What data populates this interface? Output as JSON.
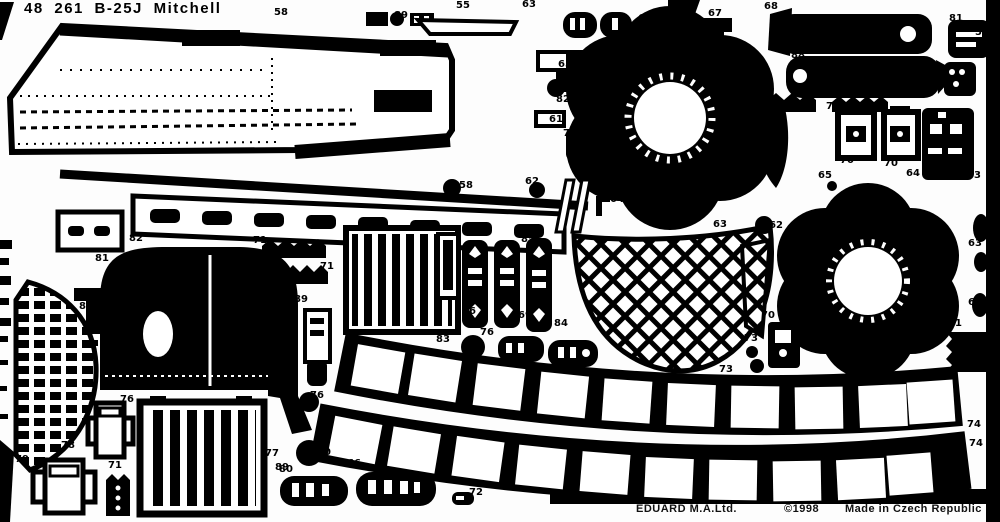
{
  "sheet": {
    "title": "48 261 B-25J Mitchell",
    "footer": {
      "maker": "EDUARD M.A.Ltd.",
      "copyright": "©1998",
      "origin": "Made in Czech Republic"
    }
  },
  "colors": {
    "etch": "#000000",
    "background": "#fdfdfd"
  },
  "parts": [
    {
      "n": "58",
      "x": 274,
      "y": 8
    },
    {
      "n": "89",
      "x": 394,
      "y": 11
    },
    {
      "n": "55",
      "x": 456,
      "y": 1
    },
    {
      "n": "63",
      "x": 522,
      "y": 0
    },
    {
      "n": "69",
      "x": 638,
      "y": 14
    },
    {
      "n": "67",
      "x": 708,
      "y": 9
    },
    {
      "n": "68",
      "x": 764,
      "y": 2
    },
    {
      "n": "88",
      "x": 791,
      "y": 51
    },
    {
      "n": "81",
      "x": 949,
      "y": 14
    },
    {
      "n": "59",
      "x": 975,
      "y": 28
    },
    {
      "n": "71",
      "x": 736,
      "y": 90
    },
    {
      "n": "71",
      "x": 826,
      "y": 102
    },
    {
      "n": "65",
      "x": 558,
      "y": 60
    },
    {
      "n": "82",
      "x": 556,
      "y": 95
    },
    {
      "n": "61",
      "x": 549,
      "y": 115
    },
    {
      "n": "73",
      "x": 563,
      "y": 129
    },
    {
      "n": "70",
      "x": 840,
      "y": 156
    },
    {
      "n": "70",
      "x": 884,
      "y": 159
    },
    {
      "n": "64",
      "x": 906,
      "y": 169
    },
    {
      "n": "65",
      "x": 818,
      "y": 171
    },
    {
      "n": "63",
      "x": 967,
      "y": 171
    },
    {
      "n": "58",
      "x": 459,
      "y": 181
    },
    {
      "n": "62",
      "x": 525,
      "y": 177
    },
    {
      "n": "64",
      "x": 610,
      "y": 195
    },
    {
      "n": "65",
      "x": 635,
      "y": 211
    },
    {
      "n": "62",
      "x": 687,
      "y": 210
    },
    {
      "n": "63",
      "x": 713,
      "y": 220
    },
    {
      "n": "62",
      "x": 769,
      "y": 221
    },
    {
      "n": "63",
      "x": 968,
      "y": 239
    },
    {
      "n": "63",
      "x": 968,
      "y": 298
    },
    {
      "n": "82",
      "x": 129,
      "y": 234
    },
    {
      "n": "81",
      "x": 95,
      "y": 254
    },
    {
      "n": "71",
      "x": 253,
      "y": 236
    },
    {
      "n": "71",
      "x": 320,
      "y": 262
    },
    {
      "n": "89",
      "x": 294,
      "y": 295
    },
    {
      "n": "80",
      "x": 79,
      "y": 302
    },
    {
      "n": "85",
      "x": 521,
      "y": 235
    },
    {
      "n": "86",
      "x": 462,
      "y": 307
    },
    {
      "n": "69",
      "x": 518,
      "y": 311
    },
    {
      "n": "84",
      "x": 554,
      "y": 319
    },
    {
      "n": "83",
      "x": 436,
      "y": 335
    },
    {
      "n": "76",
      "x": 480,
      "y": 328
    },
    {
      "n": "70",
      "x": 761,
      "y": 311
    },
    {
      "n": "73",
      "x": 744,
      "y": 334
    },
    {
      "n": "71",
      "x": 948,
      "y": 319
    },
    {
      "n": "73",
      "x": 719,
      "y": 365
    },
    {
      "n": "74",
      "x": 967,
      "y": 420
    },
    {
      "n": "74",
      "x": 969,
      "y": 439
    },
    {
      "n": "76",
      "x": 120,
      "y": 395
    },
    {
      "n": "78",
      "x": 61,
      "y": 441
    },
    {
      "n": "79",
      "x": 15,
      "y": 455
    },
    {
      "n": "71",
      "x": 108,
      "y": 461
    },
    {
      "n": "77",
      "x": 265,
      "y": 449
    },
    {
      "n": "80",
      "x": 279,
      "y": 465
    },
    {
      "n": "76",
      "x": 310,
      "y": 391
    },
    {
      "n": "70",
      "x": 317,
      "y": 448
    },
    {
      "n": "89",
      "x": 275,
      "y": 463
    },
    {
      "n": "66",
      "x": 347,
      "y": 459
    },
    {
      "n": "72",
      "x": 469,
      "y": 488
    }
  ]
}
